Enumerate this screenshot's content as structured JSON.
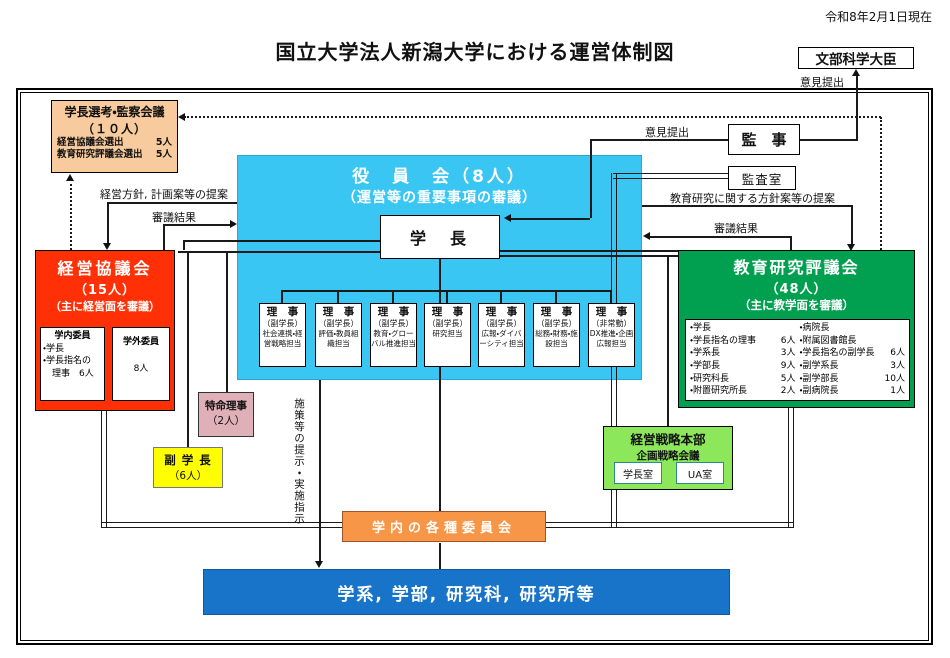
{
  "title": "国立大学法人新潟大学における運営体制図",
  "date_note": "令和8年2月1日現在",
  "minister": "文部科学大臣",
  "auditors": "監　事",
  "audit_office": "監査室",
  "labels": {
    "opinion_to_minister": "意見提出",
    "opinion_to_president": "意見提出",
    "mgmt_policy_proposal": "経営方針, 計画案等の提案",
    "council_result_left": "審議結果",
    "edu_policy_proposal": "教育研究に関する方針案等の提案",
    "council_result_right": "審議結果",
    "measures_vertical": "施策等の提示・実施指示"
  },
  "selection_council": {
    "title": "学長選考・監察会議",
    "count": "（１０人）",
    "rows": [
      {
        "label": "経営協議会選出",
        "count": "5人"
      },
      {
        "label": "教育研究評議会選出",
        "count": "5人"
      }
    ]
  },
  "board": {
    "title": "役　員　会（8人）",
    "subtitle": "（運営等の重要事項の審議）",
    "president": "学　長"
  },
  "directors": [
    {
      "title": "理　事",
      "sub": "（副学長）",
      "role": "社会連携・経営戦略担当"
    },
    {
      "title": "理　事",
      "sub": "（副学長）",
      "role": "評価・教員組織担当"
    },
    {
      "title": "理　事",
      "sub": "（副学長）",
      "role": "教育・グローバル推進担当"
    },
    {
      "title": "理　事",
      "sub": "（副学長）",
      "role": "研究担当"
    },
    {
      "title": "理　事",
      "sub": "（副学長）",
      "role": "広報・ダイバーシティ担当"
    },
    {
      "title": "理　事",
      "sub": "（副学長）",
      "role": "総務・財務・施設担当"
    },
    {
      "title": "理　事",
      "sub": "（非常勤）",
      "role": "DX推進・企画広報担当"
    }
  ],
  "management_council": {
    "title": "経営協議会",
    "count": "（15人）",
    "subtitle": "（主に経営面を審議）",
    "internal": {
      "title": "学内委員",
      "lines": [
        "・学長",
        "・学長指名の",
        "　理事　6人"
      ]
    },
    "external": {
      "title": "学外委員",
      "count": "8人"
    }
  },
  "edu_council": {
    "title": "教育研究評議会",
    "count": "（48人）",
    "subtitle": "（主に教学面を審議）",
    "left": [
      {
        "label": "・学長",
        "count": ""
      },
      {
        "label": "・学長指名の理事",
        "count": "6人"
      },
      {
        "label": "・学系長",
        "count": "3人"
      },
      {
        "label": "・学部長",
        "count": "9人"
      },
      {
        "label": "・研究科長",
        "count": "5人"
      },
      {
        "label": "・附置研究所長",
        "count": "2人"
      }
    ],
    "right": [
      {
        "label": "・病院長",
        "count": ""
      },
      {
        "label": "・附属図書館長",
        "count": ""
      },
      {
        "label": "・学長指名の副学長",
        "count": "6人"
      },
      {
        "label": "・副学系長",
        "count": "3人"
      },
      {
        "label": "・副学部長",
        "count": "10人"
      },
      {
        "label": "・副病院長",
        "count": "1人"
      }
    ]
  },
  "special_director": {
    "title": "特命理事",
    "count": "（2人）"
  },
  "vice_presidents": {
    "title": "副 学 長",
    "count": "（6人）"
  },
  "strategy_hq": {
    "title": "経営戦略本部",
    "subtitle": "企画戦略会議",
    "offices": [
      "学長室",
      "UA室"
    ]
  },
  "committees": "学内の各種委員会",
  "faculties": "学系, 学部, 研究科, 研究所等",
  "colors": {
    "board_bg": "#3AC6F3",
    "management_bg": "#FF3005",
    "education_bg": "#00A050",
    "selection_bg": "#F7CB9E",
    "special_bg": "#DFB0B8",
    "vice_bg": "#FFFF00",
    "strategy_bg": "#8CE85A",
    "committees_bg": "#F79646",
    "faculties_bg": "#1874C8"
  }
}
